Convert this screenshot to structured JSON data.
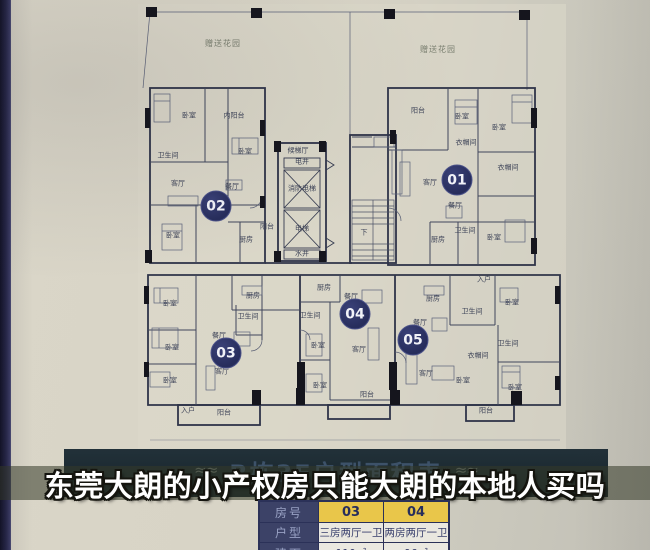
{
  "photo": {
    "caption": "东莞大朗的小产权房只能大朗的本地人买吗",
    "poster_title": "B栋3F户型面积表",
    "ornament": "≈≈"
  },
  "floorplan": {
    "garden_labels": [
      {
        "text": "赠送花园",
        "x": 223,
        "y": 44
      },
      {
        "text": "赠送花园",
        "x": 438,
        "y": 50
      }
    ],
    "units": [
      {
        "number": "02",
        "x": 216,
        "y": 206
      },
      {
        "number": "01",
        "x": 457,
        "y": 180
      },
      {
        "number": "03",
        "x": 226,
        "y": 353
      },
      {
        "number": "04",
        "x": 355,
        "y": 314
      },
      {
        "number": "05",
        "x": 413,
        "y": 340
      }
    ],
    "rooms": [
      {
        "text": "卧室",
        "x": 189,
        "y": 116
      },
      {
        "text": "内阳台",
        "x": 234,
        "y": 116
      },
      {
        "text": "卫生间",
        "x": 168,
        "y": 156
      },
      {
        "text": "卧室",
        "x": 245,
        "y": 152
      },
      {
        "text": "客厅",
        "x": 178,
        "y": 184
      },
      {
        "text": "餐厅",
        "x": 232,
        "y": 187
      },
      {
        "text": "卧室",
        "x": 173,
        "y": 236
      },
      {
        "text": "厨房",
        "x": 246,
        "y": 240
      },
      {
        "text": "阳台",
        "x": 267,
        "y": 227
      },
      {
        "text": "阳台",
        "x": 418,
        "y": 111
      },
      {
        "text": "卧室",
        "x": 462,
        "y": 117
      },
      {
        "text": "卧室",
        "x": 499,
        "y": 128
      },
      {
        "text": "衣帽间",
        "x": 466,
        "y": 143
      },
      {
        "text": "衣帽间",
        "x": 508,
        "y": 168
      },
      {
        "text": "客厅",
        "x": 430,
        "y": 183
      },
      {
        "text": "餐厅",
        "x": 455,
        "y": 206
      },
      {
        "text": "厨房",
        "x": 438,
        "y": 240
      },
      {
        "text": "卫生间",
        "x": 465,
        "y": 231
      },
      {
        "text": "卧室",
        "x": 494,
        "y": 238
      },
      {
        "text": "候梯厅",
        "x": 298,
        "y": 151
      },
      {
        "text": "电井",
        "x": 302,
        "y": 162
      },
      {
        "text": "消防电梯",
        "x": 302,
        "y": 189
      },
      {
        "text": "电梯",
        "x": 302,
        "y": 229
      },
      {
        "text": "水井",
        "x": 302,
        "y": 254
      },
      {
        "text": "下",
        "x": 364,
        "y": 233
      },
      {
        "text": "厨房",
        "x": 253,
        "y": 296
      },
      {
        "text": "卫生间",
        "x": 248,
        "y": 317
      },
      {
        "text": "卧室",
        "x": 170,
        "y": 304
      },
      {
        "text": "餐厅",
        "x": 219,
        "y": 336
      },
      {
        "text": "卧室",
        "x": 172,
        "y": 348
      },
      {
        "text": "客厅",
        "x": 222,
        "y": 372
      },
      {
        "text": "卧室",
        "x": 170,
        "y": 381
      },
      {
        "text": "入户",
        "x": 188,
        "y": 411
      },
      {
        "text": "阳台",
        "x": 224,
        "y": 413
      },
      {
        "text": "厨房",
        "x": 324,
        "y": 288
      },
      {
        "text": "餐厅",
        "x": 351,
        "y": 297
      },
      {
        "text": "卫生间",
        "x": 310,
        "y": 316
      },
      {
        "text": "卧室",
        "x": 318,
        "y": 346
      },
      {
        "text": "客厅",
        "x": 359,
        "y": 350
      },
      {
        "text": "卧室",
        "x": 320,
        "y": 386
      },
      {
        "text": "阳台",
        "x": 367,
        "y": 395
      },
      {
        "text": "入户",
        "x": 484,
        "y": 280
      },
      {
        "text": "厨房",
        "x": 433,
        "y": 299
      },
      {
        "text": "卧室",
        "x": 512,
        "y": 303
      },
      {
        "text": "餐厅",
        "x": 420,
        "y": 323
      },
      {
        "text": "卫生间",
        "x": 472,
        "y": 312
      },
      {
        "text": "卫生间",
        "x": 508,
        "y": 344
      },
      {
        "text": "衣帽间",
        "x": 478,
        "y": 356
      },
      {
        "text": "客厅",
        "x": 426,
        "y": 374
      },
      {
        "text": "卧室",
        "x": 463,
        "y": 381
      },
      {
        "text": "卧室",
        "x": 515,
        "y": 388
      },
      {
        "text": "阳台",
        "x": 486,
        "y": 411
      }
    ]
  },
  "table": {
    "rows": [
      {
        "label": "房号",
        "values": [
          "03",
          "04"
        ],
        "highlight": true
      },
      {
        "label": "户型",
        "values": [
          "三房两厅一卫",
          "两房两厅一卫"
        ],
        "highlight": false
      },
      {
        "label": "建面",
        "values": [
          "110㎡",
          "96㎡"
        ],
        "highlight": false
      }
    ]
  },
  "colors": {
    "badge_navy": "#2d3363",
    "table_yellow": "#e9c64a",
    "table_label_navy": "#3c4267",
    "banner_olive": "rgba(52,58,40,0.55)",
    "title_block": "#1b2a31",
    "poster_paper": "#d8d4c6"
  }
}
